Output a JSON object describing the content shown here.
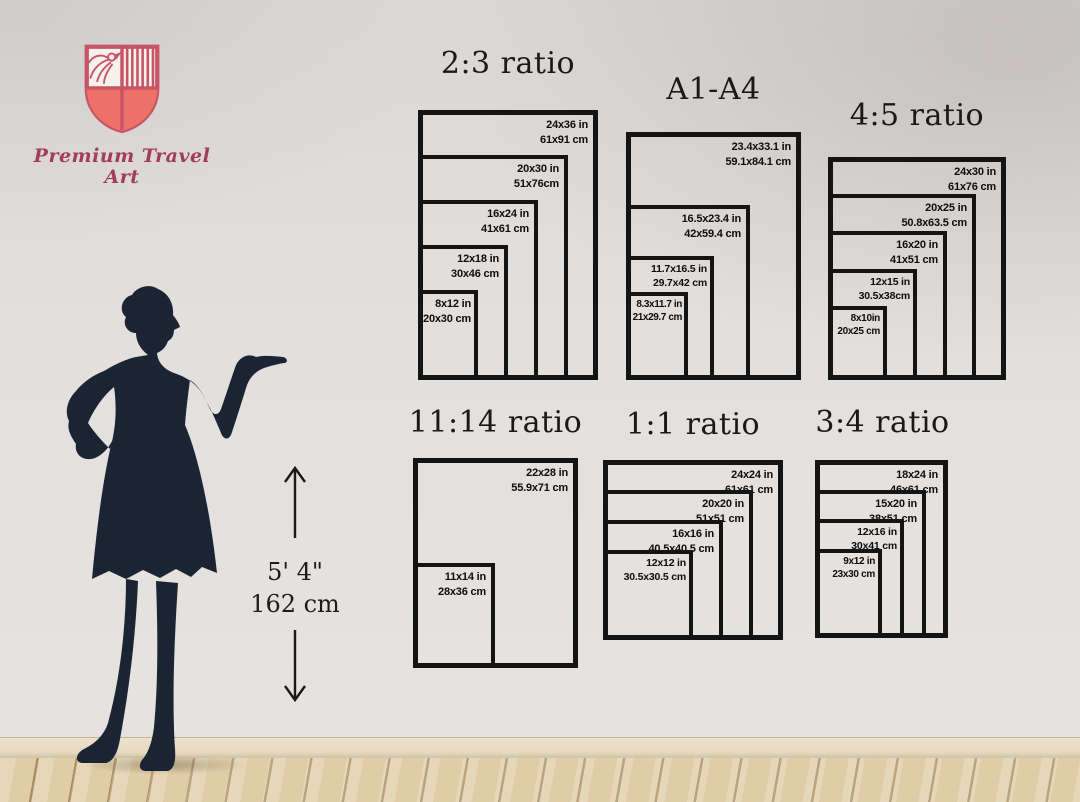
{
  "brand": {
    "name": "Premium Travel Art"
  },
  "height_reference": {
    "imperial": "5' 4\"",
    "metric": "162 cm"
  },
  "groups": [
    {
      "title": "2:3 ratio",
      "sizes": [
        {
          "in": "24x36 in",
          "cm": "61x91 cm"
        },
        {
          "in": "20x30 in",
          "cm": "51x76cm"
        },
        {
          "in": "16x24 in",
          "cm": "41x61 cm"
        },
        {
          "in": "12x18 in",
          "cm": "30x46 cm"
        },
        {
          "in": "8x12 in",
          "cm": "20x30 cm"
        }
      ]
    },
    {
      "title": "A1-A4",
      "sizes": [
        {
          "in": "23.4x33.1 in",
          "cm": "59.1x84.1 cm"
        },
        {
          "in": "16.5x23.4 in",
          "cm": "42x59.4 cm"
        },
        {
          "in": "11.7x16.5 in",
          "cm": "29.7x42 cm"
        },
        {
          "in": "8.3x11.7 in",
          "cm": "21x29.7 cm"
        }
      ]
    },
    {
      "title": "4:5 ratio",
      "sizes": [
        {
          "in": "24x30 in",
          "cm": "61x76 cm"
        },
        {
          "in": "20x25 in",
          "cm": "50.8x63.5 cm"
        },
        {
          "in": "16x20 in",
          "cm": "41x51 cm"
        },
        {
          "in": "12x15 in",
          "cm": "30.5x38cm"
        },
        {
          "in": "8x10in",
          "cm": "20x25 cm"
        }
      ]
    },
    {
      "title": "11:14 ratio",
      "sizes": [
        {
          "in": "22x28 in",
          "cm": "55.9x71 cm"
        },
        {
          "in": "11x14 in",
          "cm": "28x36 cm"
        }
      ]
    },
    {
      "title": "1:1 ratio",
      "sizes": [
        {
          "in": "24x24 in",
          "cm": "61x61 cm"
        },
        {
          "in": "20x20 in",
          "cm": "51x51 cm"
        },
        {
          "in": "16x16 in",
          "cm": "40.5x40.5 cm"
        },
        {
          "in": "12x12 in",
          "cm": "30.5x30.5 cm"
        }
      ]
    },
    {
      "title": "3:4 ratio",
      "sizes": [
        {
          "in": "18x24 in",
          "cm": "46x61 cm"
        },
        {
          "in": "15x20 in",
          "cm": "38x51 cm"
        },
        {
          "in": "12x16 in",
          "cm": "30x41 cm"
        },
        {
          "in": "9x12 in",
          "cm": "23x30 cm"
        }
      ]
    }
  ],
  "colors": {
    "accent_crimson": "#c75566",
    "shield_fill": "#ed7168",
    "silhouette": "#1b2433",
    "box_line": "#141414",
    "wall": "#e2dfdd",
    "floor_wood": "#dcc8a2"
  }
}
